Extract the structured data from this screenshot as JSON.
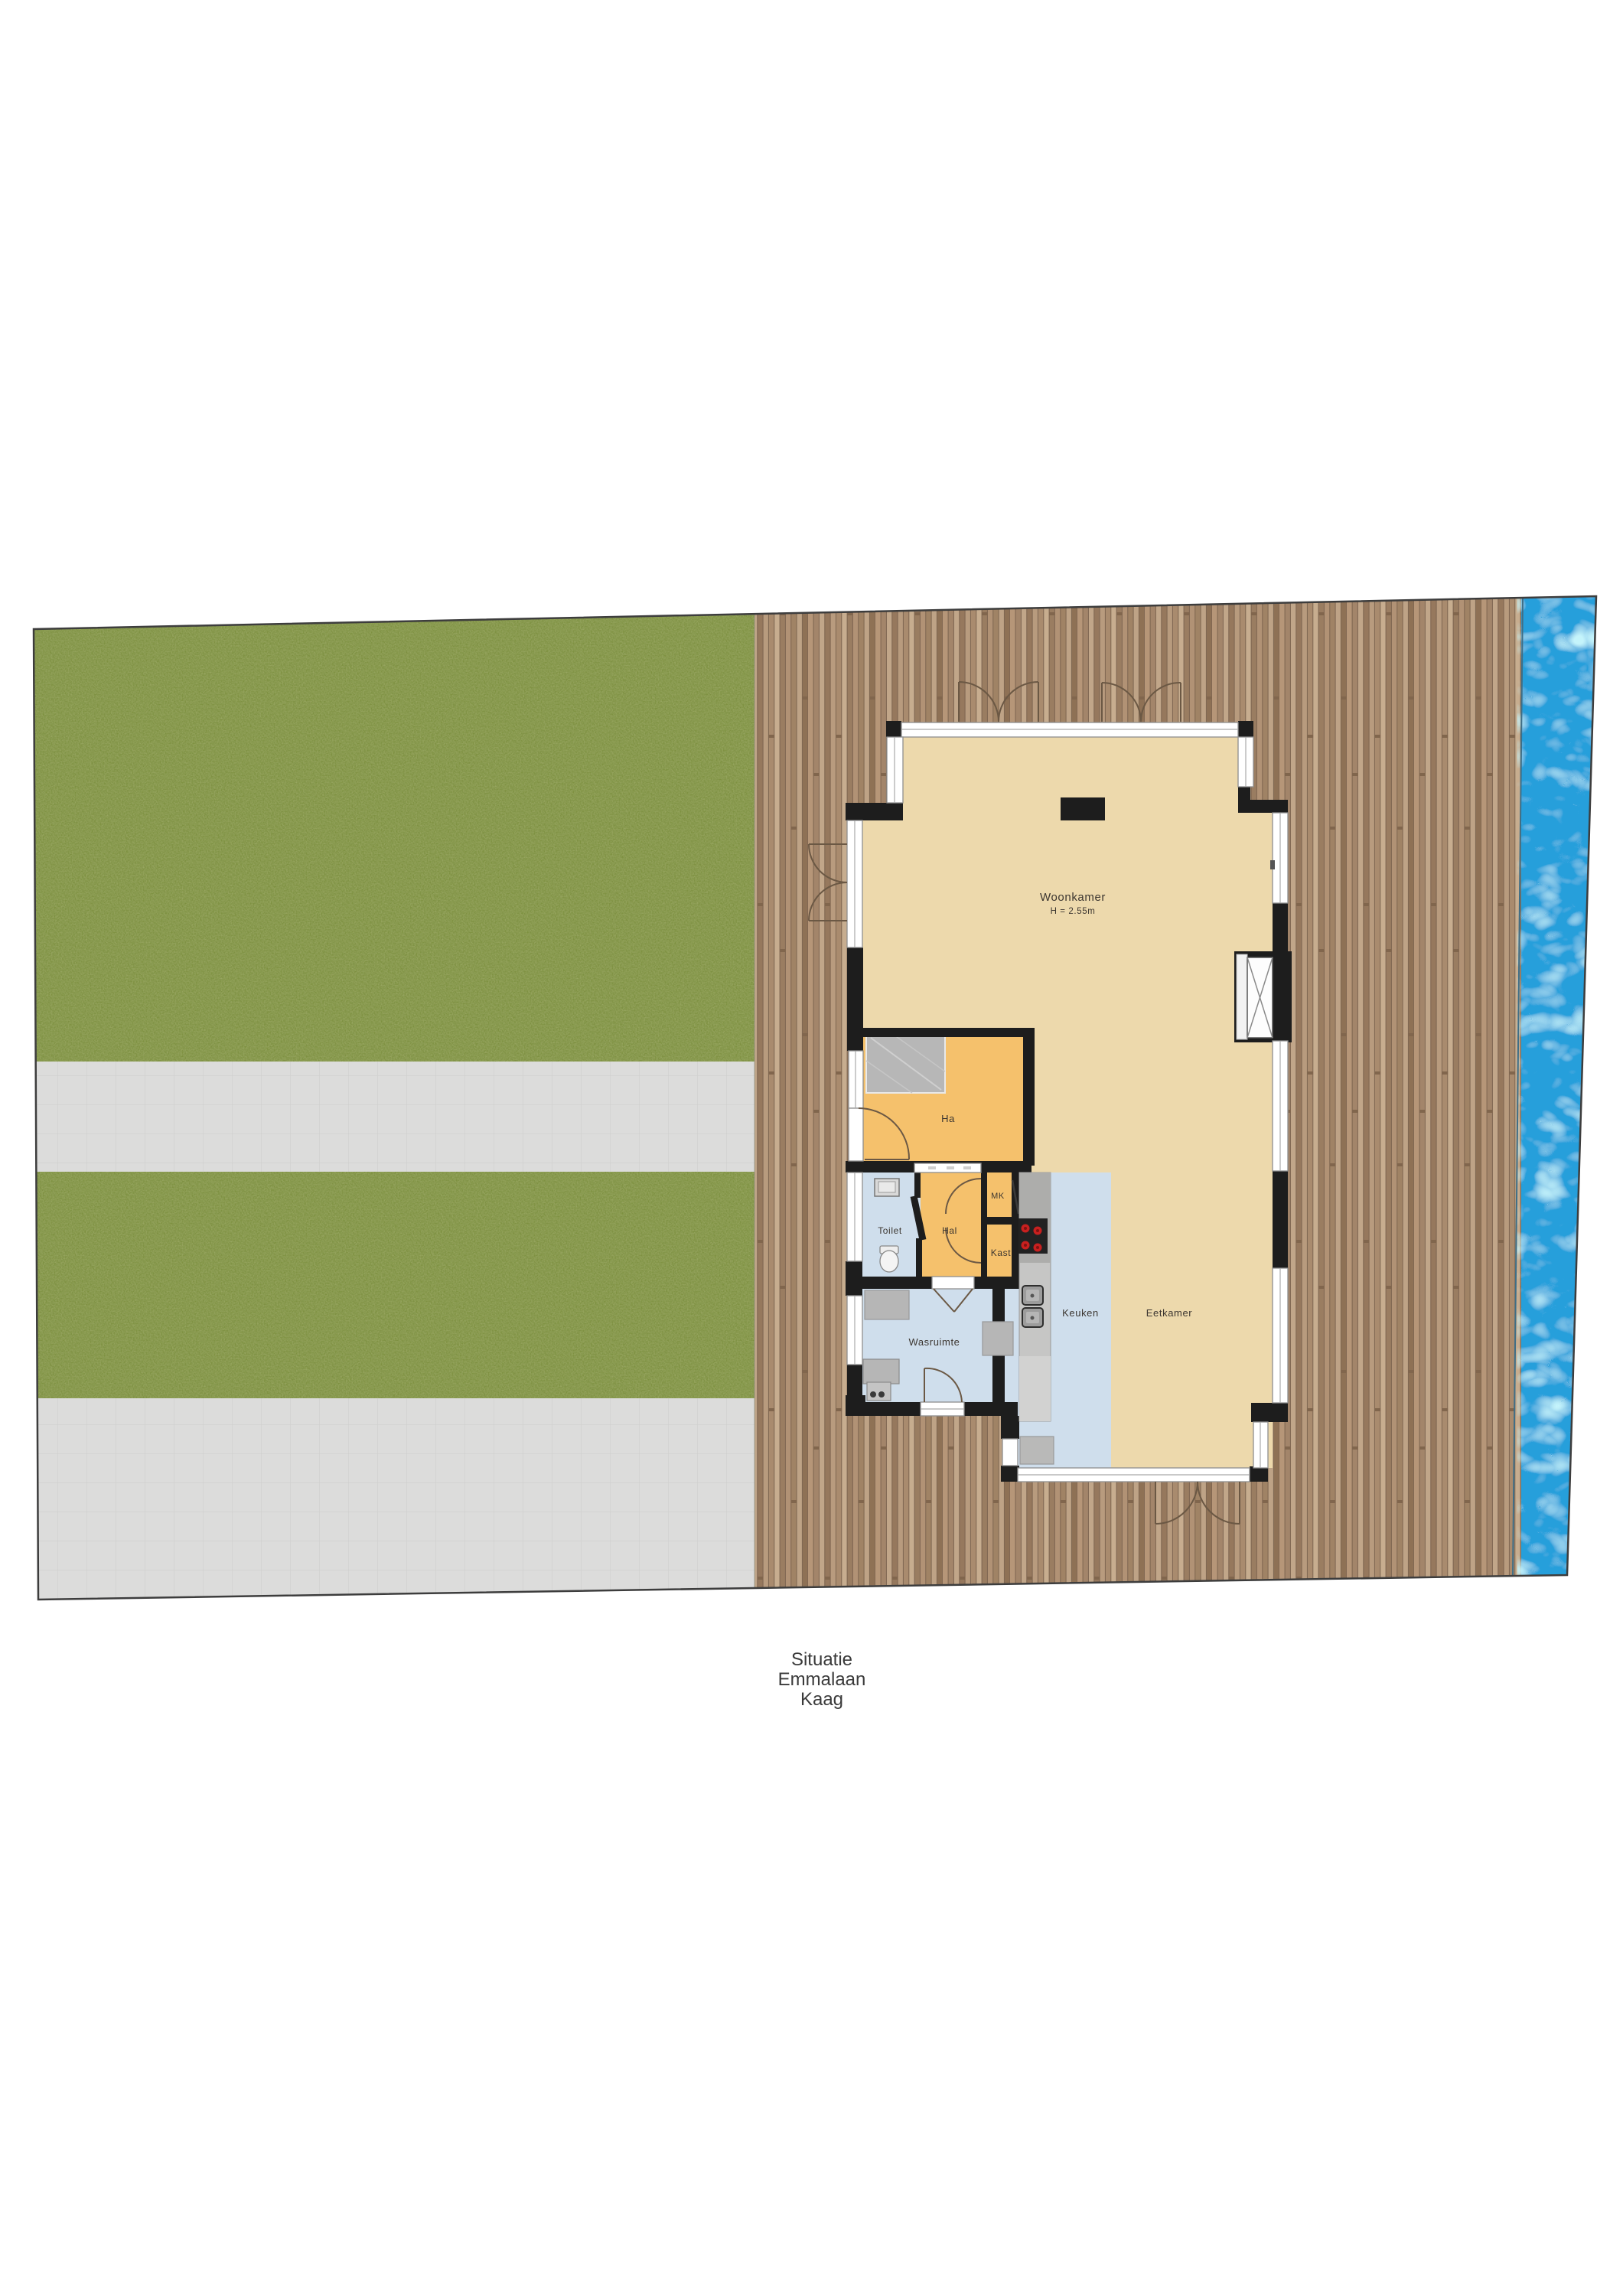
{
  "plan": {
    "type": "situation-floorplan",
    "caption": {
      "line1": "Situatie",
      "line2": "Emmalaan",
      "line3": "Kaag"
    },
    "rooms": {
      "woonkamer": {
        "label": "Woonkamer",
        "height_note": "H = 2.55m"
      },
      "ha": {
        "label": "Ha"
      },
      "toilet": {
        "label": "Toilet"
      },
      "hal": {
        "label": "Hal"
      },
      "mk": {
        "label": "MK"
      },
      "kast": {
        "label": "Kast"
      },
      "keuken": {
        "label": "Keuken"
      },
      "eetkamer": {
        "label": "Eetkamer"
      },
      "wasruimte": {
        "label": "Wasruimte"
      }
    },
    "colors": {
      "grass": "#7e9141",
      "pavement": "#dcdcdb",
      "deck_wood": "#b29378",
      "water": "#259fdb",
      "floor_tan": "#edd9ac",
      "floor_orange": "#f5c16c",
      "floor_blue": "#cfdeec",
      "wall": "#1d1d1d"
    }
  }
}
